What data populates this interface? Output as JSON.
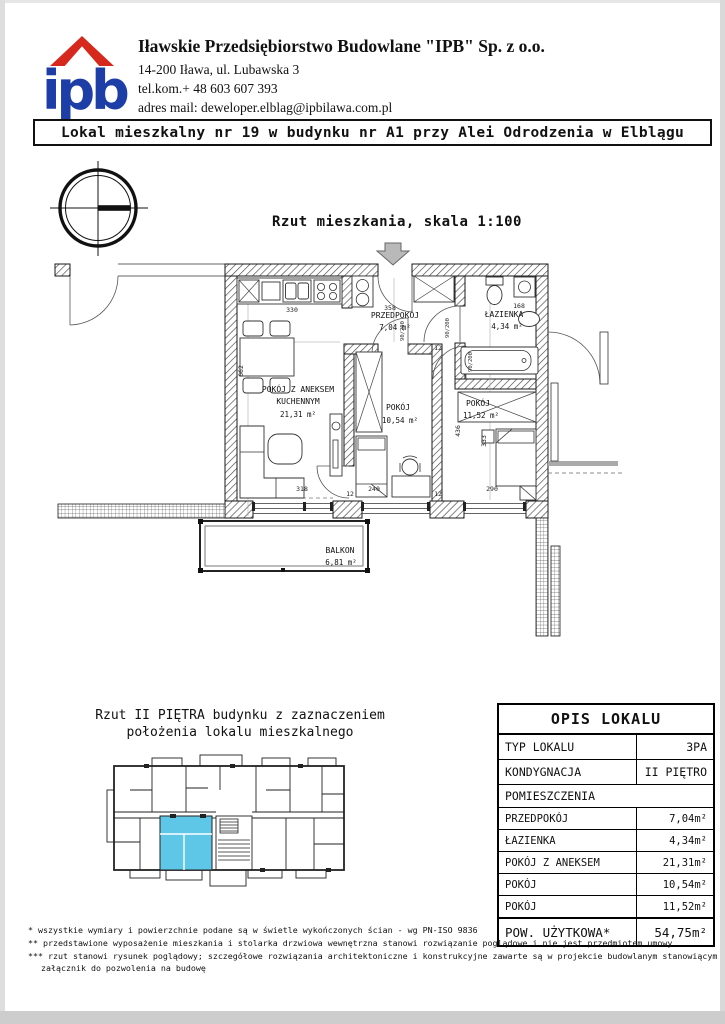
{
  "colors": {
    "logo_blue": "#1c3ea6",
    "logo_red": "#d6281d",
    "highlight_cyan": "#5ec7e8"
  },
  "header": {
    "logo_text": "ipb",
    "company_name": "Iławskie Przedsiębiorstwo Budowlane \"IPB\" Sp. z o.o.",
    "address": "14-200 Iława, ul. Lubawska 3",
    "phone": "tel.kom.+ 48 603 607 393",
    "email": "adres mail: deweloper.elblag@ipbilawa.com.pl"
  },
  "title_bar": "Lokal mieszkalny nr 19 w budynku nr A1 przy Alei Odrodzenia w Elblągu",
  "plan": {
    "caption": "Rzut mieszkania, skala 1:100",
    "rooms": {
      "przedpokoj": {
        "name": "PRZEDPOKÓJ",
        "area": "7,04 m²"
      },
      "lazienka": {
        "name": "ŁAZIENKA",
        "area": "4,34 m²"
      },
      "salon_l1": "POKÓJ Z ANEKSEM",
      "salon_l2": "KUCHENNYM",
      "salon_area": "21,31 m²",
      "pokoj1": {
        "name": "POKÓJ",
        "area": "10,54 m²"
      },
      "pokoj2": {
        "name": "POKÓJ",
        "area": "11,52 m²"
      },
      "balkon": {
        "name": "BALKON",
        "area": "6,81 m²"
      }
    },
    "dims": {
      "kitchen": "330",
      "hall": "358",
      "bath": "168",
      "left_wall": "662",
      "living": "318",
      "middle": "240",
      "right": "290",
      "right_v": "333",
      "middle_v": "436",
      "thk": "12",
      "door": "90/200"
    }
  },
  "mini_plan": {
    "caption_l1": "Rzut II PIĘTRA budynku z zaznaczeniem",
    "caption_l2": "położenia lokalu mieszkalnego"
  },
  "table": {
    "title": "OPIS LOKALU",
    "rows": [
      {
        "label": "TYP LOKALU",
        "value": "3PA"
      },
      {
        "label": "KONDYGNACJA",
        "value": "II PIĘTRO"
      },
      {
        "label": "POMIESZCZENIA",
        "value": ""
      },
      {
        "label": "PRZEDPOKÓJ",
        "value": "7,04m²"
      },
      {
        "label": "ŁAZIENKA",
        "value": "4,34m²"
      },
      {
        "label": "POKÓJ Z ANEKSEM",
        "value": "21,31m²"
      },
      {
        "label": "POKÓJ",
        "value": "10,54m²"
      },
      {
        "label": "POKÓJ",
        "value": "11,52m²"
      },
      {
        "label": "POW. UŻYTKOWA*",
        "value": "54,75m²"
      }
    ]
  },
  "footnotes": [
    "* wszystkie wymiary i powierzchnie podane są w świetle wykończonych ścian - wg PN-ISO 9836",
    "** przedstawione wyposażenie mieszkania i stolarka drzwiowa wewnętrzna stanowi rozwiązanie poglądowe i nie jest przedmiotem umowy",
    "*** rzut stanowi rysunek poglądowy; szczegółowe rozwiązania architektoniczne i konstrukcyjne zawarte są w projekcie budowlanym stanowiącym",
    "załącznik do pozwolenia na budowę"
  ]
}
